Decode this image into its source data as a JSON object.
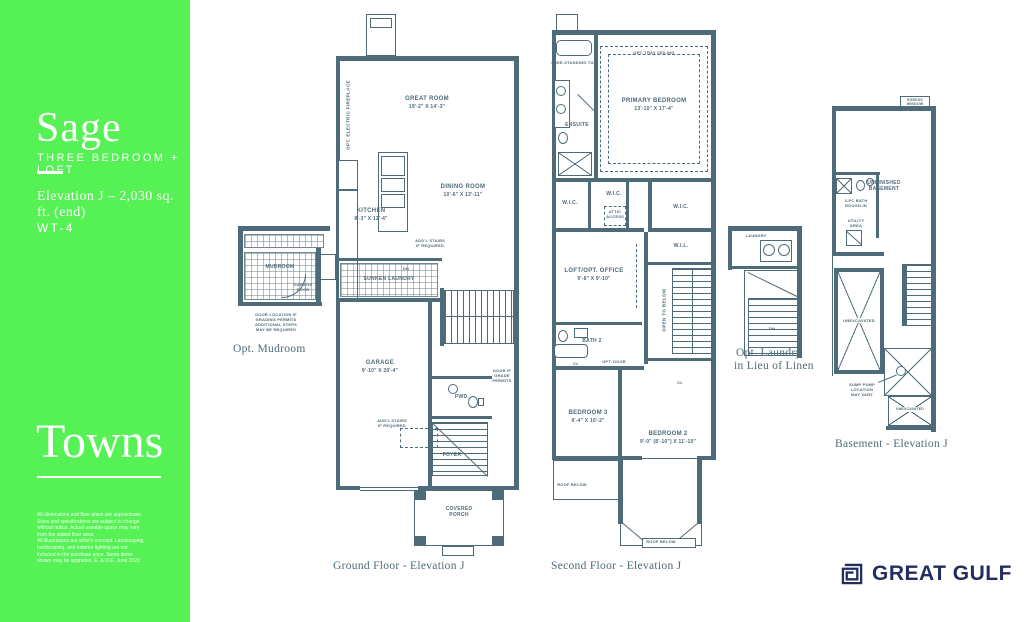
{
  "sidebar": {
    "model_name": "Sage",
    "model_type": "THREE BEDROOM + LOFT",
    "elevation_info": "Elevation J – 2,030 sq. ft. (end)",
    "unit_code": "WT-4",
    "collection": "Towns",
    "disclaimer": [
      "All dimensions and floor plans are approximate.",
      "Sizes and specifications are subject to change",
      "without notice. Actual useable space may vary",
      "from the stated floor area.",
      "All illustrations are artist's concept. Landscaping,",
      "hardscaping, and exterior lighting are not",
      "included in the purchase price. Some items",
      "shown may be upgrades. E. & O.E. June 2023"
    ]
  },
  "ground": {
    "caption": "Ground Floor - Elevation J",
    "great_room_name": "GREAT ROOM",
    "great_room_dims": "19'-2\" X 14'-3\"",
    "dining_name": "DINING ROOM",
    "dining_dims": "10'-6\" X 13'-11\"",
    "kitchen_name": "KITCHEN",
    "kitchen_dims": "8'-3\" X 12'-4\"",
    "laundry_label": "SUNKEN LAUNDRY",
    "garage_name": "GARAGE",
    "garage_dims": "9'-10\" X 20'-4\"",
    "pwd_label": "PWD.",
    "foyer_label": "FOYER",
    "porch_label": "COVERED PORCH",
    "fireplace_note": "OPT. ELECTRIC FIREPLACE",
    "stairs_note_1": "ADD'L STAIRS IF REQUIRED",
    "stairs_note_2": "ADD'L STAIRS IF REQUIRED",
    "grade_note": "DOOR IF GRADE PERMITS",
    "dn_label": "DN"
  },
  "mudroom": {
    "caption": "Opt. Mudroom",
    "room_label": "MUDROOM",
    "door_label": "GARAGE DOOR",
    "note": "DOOR LOCATION IF GRADING PERMITS ADDITIONAL STEPS MAY BE REQUIRED"
  },
  "second": {
    "caption": "Second Floor - Elevation J",
    "primary_name": "PRIMARY BEDROOM",
    "primary_dims": "13'-10\" X 17'-4\"",
    "tray_note": "OPT. TRAY CEILING",
    "ensuite_label": "ENSUITE",
    "tub_note": "FREE-STANDING TUB",
    "wic_1": "W.I.C.",
    "wic_2": "W.I.C.",
    "wic_3": "W.I.C.",
    "wil_label": "W.I.L.",
    "attic_note": "ATTIC ACCESS",
    "loft_name": "LOFT/OPT. OFFICE",
    "loft_dims": "9'-8\" X 9'-10\"",
    "open_below_note": "OPEN TO BELOW",
    "bath2_label": "BATH 2",
    "opt_door_note": "OPT. DOOR",
    "cl_1": "CL",
    "cl_2": "CL",
    "bed3_name": "BEDROOM 3",
    "bed3_dims": "9'-4\" X 10'-2\"",
    "bed2_name": "BEDROOM 2",
    "bed2_dims": "9'-0\" (8'-10\") X 11'-10\"",
    "roof_below_1": "ROOF BELOW",
    "roof_below_2": "ROOF BELOW"
  },
  "opt_laundry": {
    "caption_line1": "Opt. Laundry",
    "caption_line2": "in Lieu of Linen",
    "room_label": "LAUNDRY",
    "dn_label": "DN"
  },
  "basement": {
    "caption": "Basement - Elevation J",
    "window_label": "EGRESS WINDOW",
    "unfinished_label": "UNFINISHED BASEMENT",
    "utility_label": "UTILITY AREA",
    "rough_in_note": "3-PC BATH ROUGH-IN",
    "unexcavated_1": "UNEXCAVATED",
    "unexcavated_2": "UNEXCAVATED",
    "sump_note": "SUMP PUMP LOCATION MAY VARY"
  },
  "logo": {
    "text": "GREAT GULF"
  }
}
